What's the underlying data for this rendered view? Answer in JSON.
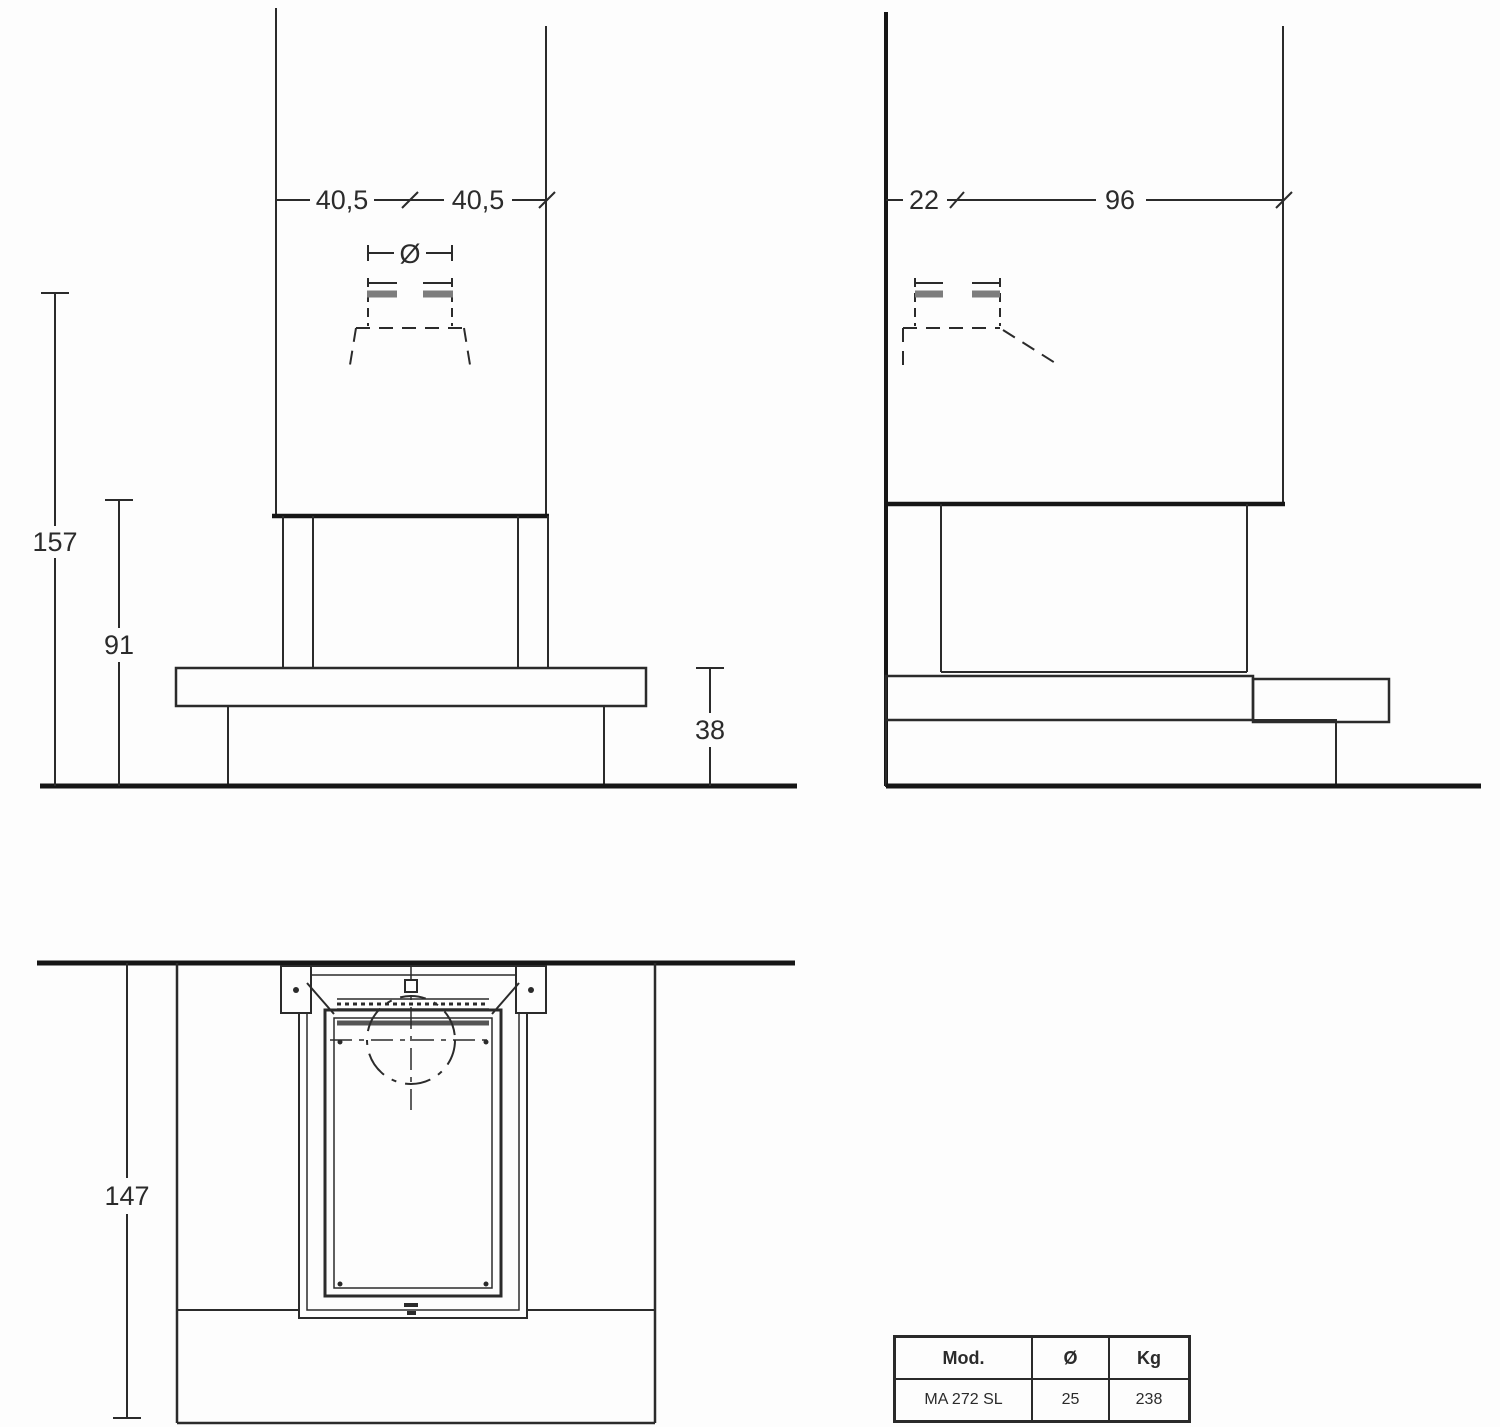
{
  "front_view": {
    "dims": {
      "half_width_left": "40,5",
      "half_width_right": "40,5",
      "flue_diameter_symbol": "Ø",
      "total_height": "157",
      "opening_height": "91",
      "base_height": "38"
    }
  },
  "side_view": {
    "dims": {
      "wall_offset": "22",
      "depth": "96"
    }
  },
  "plan_view": {
    "dims": {
      "depth_total": "147"
    }
  },
  "spec_table": {
    "headers": {
      "model": "Mod.",
      "diameter": "Ø",
      "weight": "Kg"
    },
    "row": {
      "model": "MA 272 SL",
      "diameter": "25",
      "weight": "238"
    }
  },
  "colors": {
    "background": "#fdfdfd",
    "line": "#2b2b2b",
    "bold_line": "#161616",
    "gray_bar": "#7d7d7d",
    "text": "#2b2b2b"
  }
}
